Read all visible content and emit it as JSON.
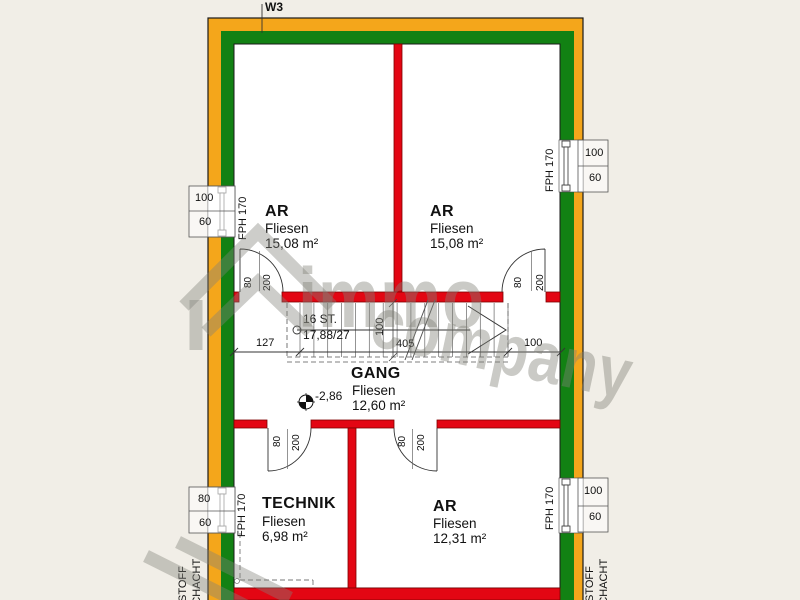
{
  "plan": {
    "wall_tag": "W3",
    "rooms": [
      {
        "name": "AR",
        "floor": "Fliesen",
        "area": "15,08 m²"
      },
      {
        "name": "AR",
        "floor": "Fliesen",
        "area": "15,08 m²"
      },
      {
        "name": "GANG",
        "floor": "Fliesen",
        "area": "12,60 m²"
      },
      {
        "name": "TECHNIK",
        "floor": "Fliesen",
        "area": "6,98 m²"
      },
      {
        "name": "AR",
        "floor": "Fliesen",
        "area": "12,31 m²"
      }
    ],
    "stair": {
      "steps_label": "16 ST.",
      "ratio_label": "17,88/27",
      "width_label": "100"
    },
    "dimensions": {
      "left": "127",
      "run": "405",
      "right": "100"
    },
    "level_label": "-2,86",
    "windows": [
      {
        "width_label": "100",
        "height_label": "60",
        "sill_label": "FPH 170"
      },
      {
        "width_label": "100",
        "height_label": "60",
        "sill_label": "FPH 170"
      },
      {
        "width_label": "80",
        "height_label": "60",
        "sill_label": "FPH 170"
      },
      {
        "width_label": "100",
        "height_label": "60",
        "sill_label": "FPH 170"
      }
    ],
    "doors": [
      {
        "width_label": "80",
        "height_label": "200"
      },
      {
        "width_label": "80",
        "height_label": "200"
      },
      {
        "width_label": "80",
        "height_label": "200"
      },
      {
        "width_label": "80",
        "height_label": "200"
      }
    ],
    "shafts": [
      {
        "word1": "STOFF",
        "word2": "SCHACHT"
      },
      {
        "word1": "STOFF",
        "word2": "SCHACHT"
      }
    ],
    "watermark": {
      "word1": "immo",
      "word2": "company"
    },
    "colors": {
      "insulation_yellow": "#f4a61b",
      "exterior_wall_green": "#128113",
      "interior_wall_red": "#e30613",
      "background": "#f1eee7"
    }
  }
}
